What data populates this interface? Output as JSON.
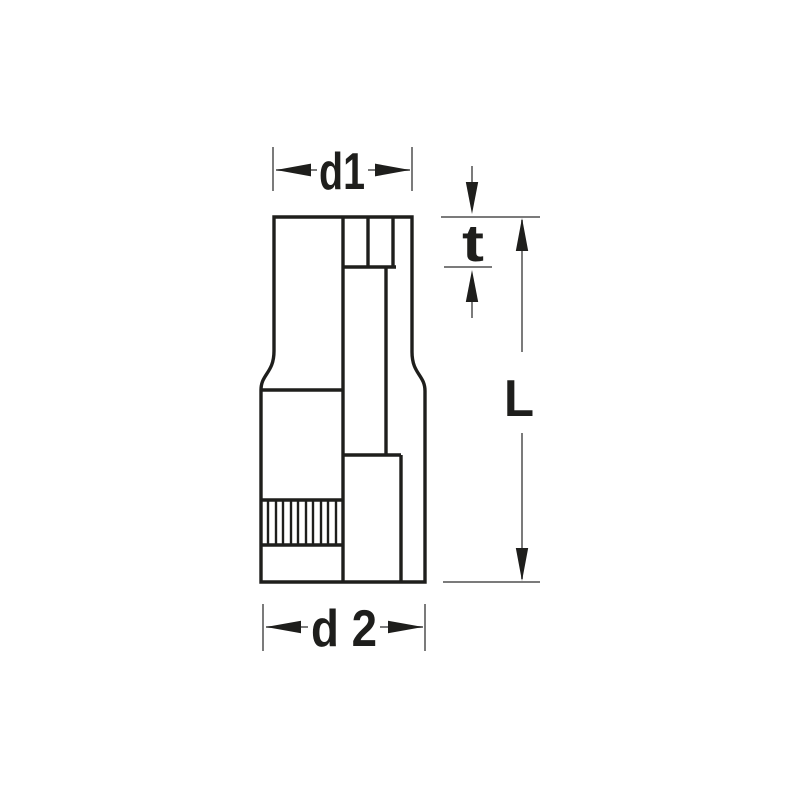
{
  "diagram": {
    "type": "technical-drawing",
    "subject": "socket-tool-side-view-with-dimensions",
    "labels": {
      "top_diameter": "d1",
      "insert_depth": "t",
      "overall_length": "L",
      "bottom_diameter": "d 2"
    },
    "colors": {
      "background": "#ffffff",
      "outline": "#1e1e1c",
      "dimension_line": "#7b7b7b",
      "arrow_and_text": "#1e1e1c"
    }
  }
}
